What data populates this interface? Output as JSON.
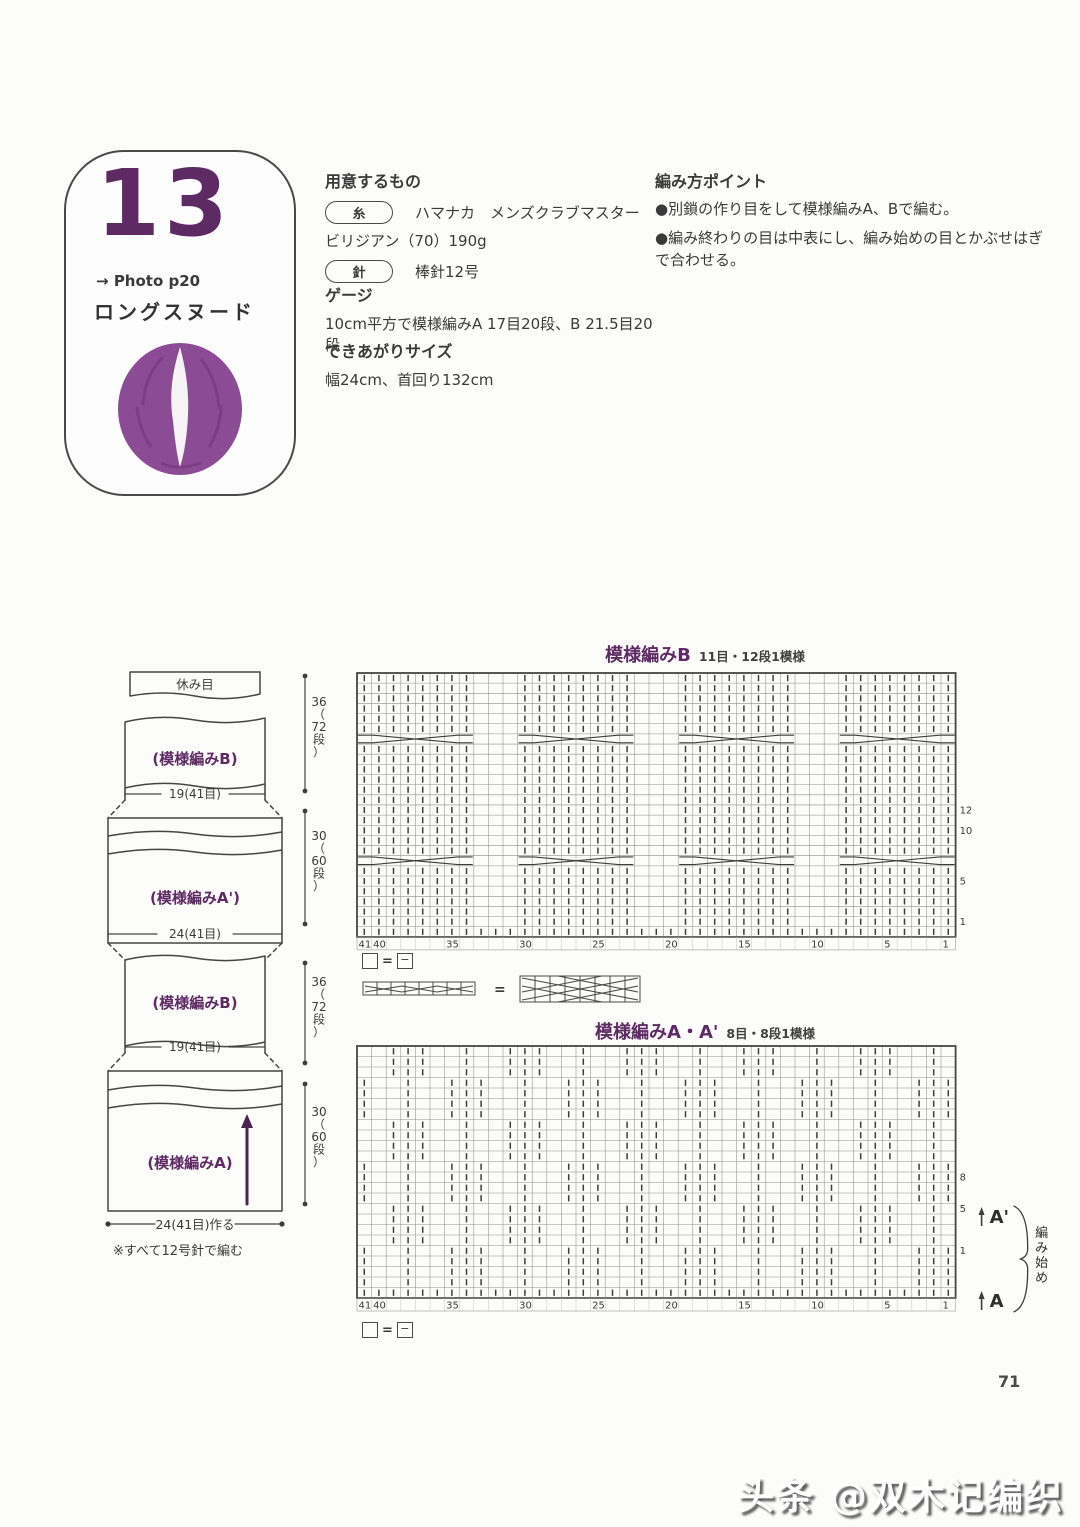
{
  "page": {
    "number": "71",
    "watermark": "头条 @双木记编织"
  },
  "card": {
    "number": "13",
    "arrow": "→",
    "photo_ref": "Photo p20",
    "title": "ロングスヌード"
  },
  "materials": {
    "heading": "用意するもの",
    "yarn_label": "糸",
    "yarn_line1": "ハマナカ　メンズクラブマスター",
    "yarn_line2": "ビリジアン（70）190g",
    "needle_label": "針",
    "needle_text": "棒針12号"
  },
  "gauge": {
    "heading": "ゲージ",
    "text": "10cm平方で模様編みA 17目20段、B 21.5目20段"
  },
  "size": {
    "heading": "できあがりサイズ",
    "text": "幅24cm、首回り132cm"
  },
  "points": {
    "heading": "編み方ポイント",
    "items": [
      "●別鎖の作り目をして模様編みA、Bで編む。",
      "●編み終わりの目は中表にし、編み始めの目とかぶせはぎで合わせる。"
    ]
  },
  "schematic": {
    "rest_label": "休み目",
    "block_b_label": "(模様編みB)",
    "block_a2_label": "(模様編みA')",
    "block_a_label": "(模様編みA)",
    "width_b": "19(41目)",
    "width_a2": "24(41目)",
    "measure_b": "36（72段）",
    "measure_a": "30（60段）",
    "bottom_label": "24(41目)作る",
    "note": "※すべて12号針で編む"
  },
  "charts": {
    "b": {
      "title": "模様編みB",
      "subtitle": "11目・12段1模様",
      "stitches": 41,
      "rows": 26,
      "cast_on_row": true,
      "knit_groups": [
        [
          1,
          8
        ],
        [
          12,
          19
        ],
        [
          23,
          30
        ],
        [
          34,
          41
        ]
      ],
      "cable_rows": [
        7,
        19
      ],
      "col_labels": [
        41,
        40,
        35,
        30,
        25,
        20,
        15,
        10,
        5,
        1
      ],
      "row_labels": [
        12,
        10,
        5,
        1
      ],
      "row_label_offset": 0
    },
    "a": {
      "title": "模様編みA・A'",
      "subtitle": "8目・8段1模様",
      "stitches": 41,
      "rows": 24,
      "cast_on_row": true,
      "repeat": 8,
      "block_rows": 4,
      "col_labels": [
        41,
        40,
        35,
        30,
        25,
        20,
        15,
        10,
        5,
        1
      ],
      "row_labels": [
        8,
        5,
        1
      ],
      "row_label_offset": 3,
      "marker_top": "A'",
      "marker_bottom": "A",
      "start_label": "編み始め"
    }
  },
  "legend": {
    "equals": "=",
    "purl": "−"
  },
  "colors": {
    "accent": "#5e2a63",
    "snood": "#8c4b95",
    "text": "#3a3a3a",
    "grid": "#8f8f8f",
    "line": "#454545"
  }
}
